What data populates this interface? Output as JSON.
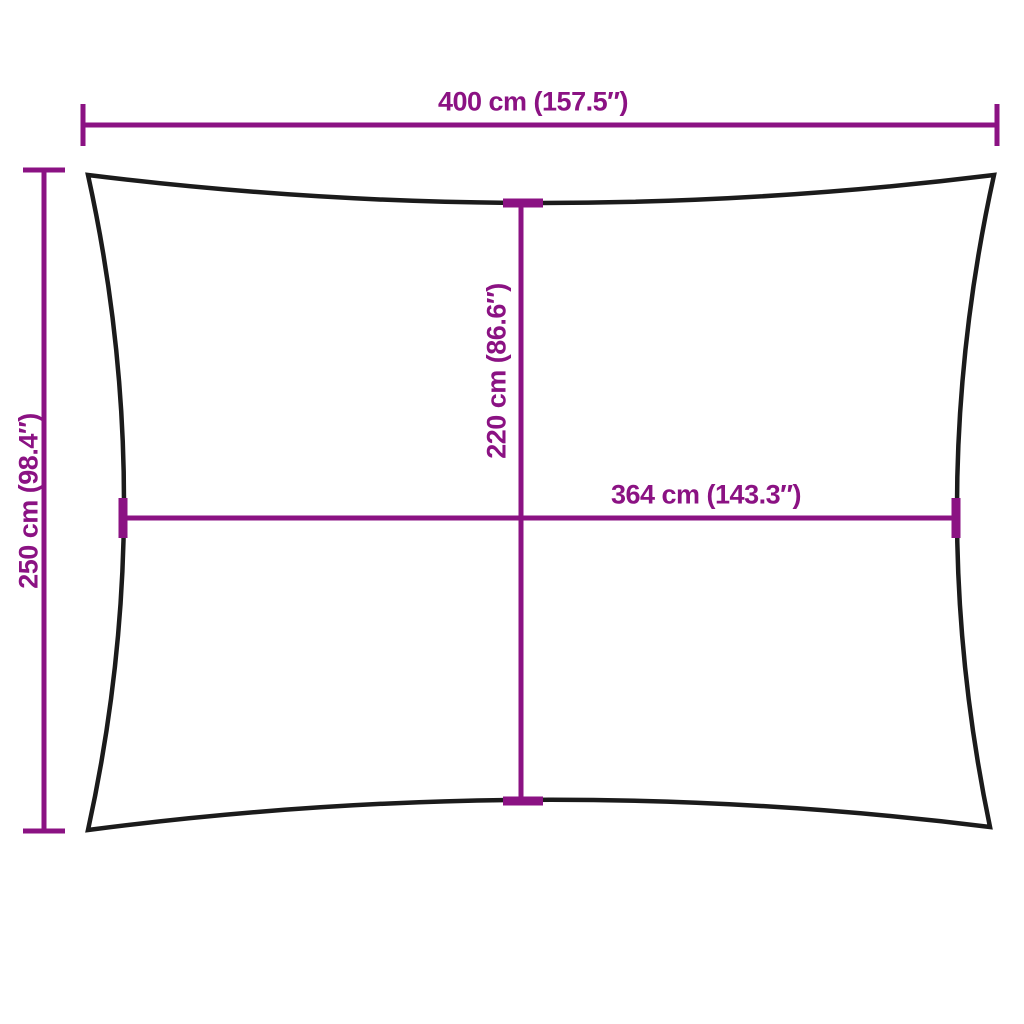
{
  "diagram": {
    "colors": {
      "dimension": "#8B1283",
      "outline": "#1B1B1B",
      "background": "#FFFFFF"
    },
    "dimensions": {
      "top_width": {
        "label": "400 cm (157.5″)",
        "cm": 400,
        "inches": 157.5
      },
      "left_height": {
        "label": "250 cm (98.4″)",
        "cm": 250,
        "inches": 98.4
      },
      "inner_height": {
        "label": "220 cm (86.6″)",
        "cm": 220,
        "inches": 86.6
      },
      "inner_width": {
        "label": "364 cm (143.3″)",
        "cm": 364,
        "inches": 143.3
      }
    }
  }
}
